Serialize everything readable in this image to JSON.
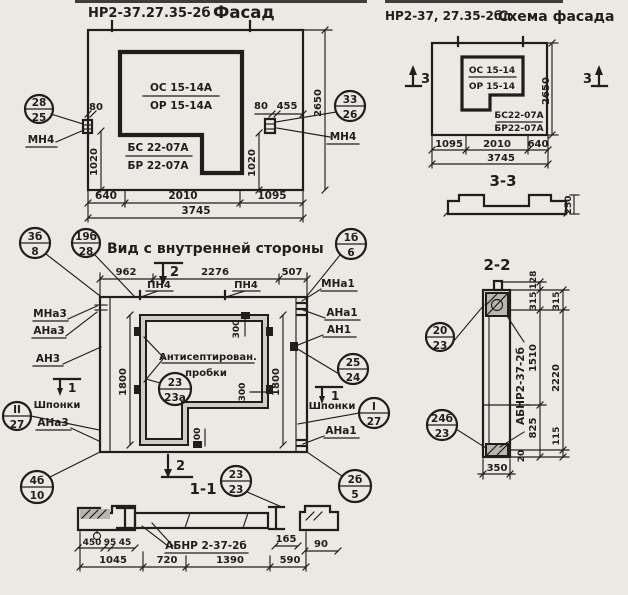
{
  "colors": {
    "paper": "#ebe9e4",
    "ink": "#201e1b",
    "shade": "#cfcdc6",
    "hatch": "#b8b6af"
  },
  "facade": {
    "title_code": "НР2-37.27.35-2б",
    "title_name": "Фасад",
    "frac_top": "ОС 15-14А",
    "frac_bot": "ОР 15-14А",
    "panel_top": "БС 22-07А",
    "panel_bot": "БР 22-07А",
    "callout_left": {
      "top": "28",
      "bot": "25"
    },
    "callout_right": {
      "top": "33",
      "bot": "26"
    },
    "anchor_label": "МН4",
    "dim_80_left": "80",
    "dim_80_right": "80",
    "dim_455": "455",
    "dim_1020_left": "1020",
    "dim_1020_right": "1020",
    "dim_height": "2650",
    "dims_bottom": [
      "640",
      "2010",
      "1095"
    ],
    "dim_total": "3745"
  },
  "scheme": {
    "title_code": "НР2-37, 27.35-2бл",
    "title_name": "Схема фасада",
    "frac_top": "ОС 15-14",
    "frac_bot": "ОР 15-14",
    "panel_top": "БС22-07А",
    "panel_bot": "БР22-07А",
    "marker": "3",
    "dim_height": "2650",
    "dims_bottom": [
      "1095",
      "2010",
      "640"
    ],
    "dim_total": "3745",
    "section_title": "3-3",
    "dim_250": "250"
  },
  "inner": {
    "title": "Вид с внутренней стороны",
    "callout_tl1": {
      "top": "3б",
      "bot": "8"
    },
    "callout_tl2": {
      "top": "19б",
      "bot": "28"
    },
    "callout_tr": {
      "top": "1б",
      "bot": "6"
    },
    "callout_bl": {
      "top": "4б",
      "bot": "10"
    },
    "callout_br": {
      "top": "2б",
      "bot": "5"
    },
    "callout_note": {
      "top": "23",
      "bot": "23а"
    },
    "callout_hw": {
      "top": "25",
      "bot": "24"
    },
    "callout_key_left": {
      "top": "II",
      "bot": "27"
    },
    "callout_key_right": {
      "top": "I",
      "bot": "27"
    },
    "callout_section": {
      "top": "23",
      "bot": "23"
    },
    "labels_left": [
      "МНа3",
      "АНа3",
      "АН3",
      "Шпонки",
      "АНа3"
    ],
    "labels_right": [
      "МНа1",
      "АНа1",
      "АН1",
      "Шпонки",
      "АНа1"
    ],
    "pn4": "ПН4",
    "note_line1": "Антисептирован.",
    "note_line2": "пробки",
    "marker_1": "1",
    "marker_2": "2",
    "dims_top": [
      "962",
      "2276",
      "507"
    ],
    "dim_300": "300",
    "dim_1800": "1800",
    "section_title": "1-1"
  },
  "section11": {
    "label": "АБНР 2-37-2б",
    "dims_small": [
      "450",
      "95",
      "45"
    ],
    "dim_165": "165",
    "dim_90": "90",
    "dims_bottom": [
      "1045",
      "720",
      "1390",
      "590"
    ]
  },
  "section22": {
    "title": "2-2",
    "label": "АБНР2-37-2б",
    "callout_top": {
      "top": "20",
      "bot": "23"
    },
    "callout_bottom": {
      "top": "24б",
      "bot": "23"
    },
    "chain_inner": [
      "128",
      "315",
      "1510",
      "825"
    ],
    "chain_outer": [
      "315",
      "2220",
      "115"
    ],
    "dim_20": "20",
    "dim_350": "350"
  }
}
